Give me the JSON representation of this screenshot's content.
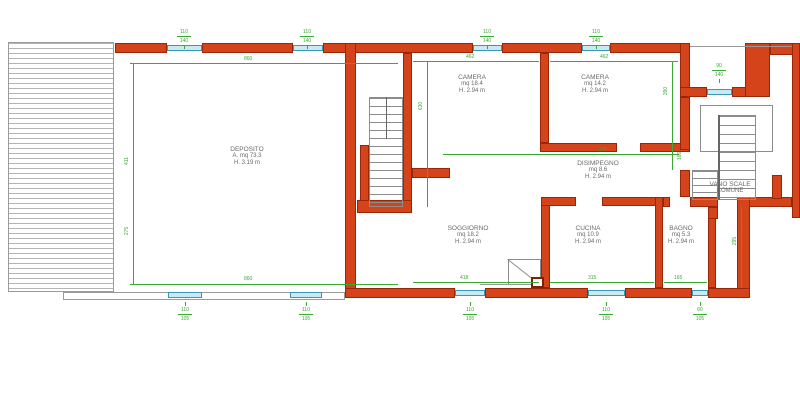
{
  "rooms": [
    {
      "name": "DEPOSITO",
      "l2": "A.   mq 73.3",
      "l3": "H.   3.19 m"
    },
    {
      "name": "CAMERA",
      "l2": "mq 18.4",
      "l3": "H.   2.94 m"
    },
    {
      "name": "CAMERA",
      "l2": "mq 14.2",
      "l3": "H.   2.94 m"
    },
    {
      "name": "DISIMPEGNO",
      "l2": "mq 8.6",
      "l3": "H.   2.94 m"
    },
    {
      "name": "SOGGIORNO",
      "l2": "mq 18.2",
      "l3": "H.   2.94 m"
    },
    {
      "name": "CUCINA",
      "l2": "mq 10.9",
      "l3": "H.   2.94 m"
    },
    {
      "name": "BAGNO",
      "l2": "mq 5.3",
      "l3": "H.   2.94 m"
    },
    {
      "name": "VANO SCALE",
      "l2": "COMUNE",
      "l3": ""
    }
  ],
  "dims": {
    "dep_top": "860",
    "dep_bottom": "860",
    "dep_left_upper": "411",
    "dep_left_lower": "275",
    "cam1_w": "462",
    "cam2_w": "462",
    "cam1_h": "630",
    "cam2_h": "390",
    "hall_w": "274",
    "hall_right": "166",
    "sogg_w": "418",
    "cuc_w": "315",
    "bagno_w": "165",
    "bagno_right": "295"
  },
  "window_dims": [
    {
      "id": "top-1",
      "w": "110",
      "h": "140"
    },
    {
      "id": "top-2",
      "w": "110",
      "h": "140"
    },
    {
      "id": "top-3",
      "w": "110",
      "h": "140"
    },
    {
      "id": "top-4",
      "w": "110",
      "h": "140"
    },
    {
      "id": "stairwell",
      "w": "90",
      "h": "140"
    },
    {
      "id": "bottom-1",
      "w": "110",
      "h": "105"
    },
    {
      "id": "bottom-2",
      "w": "110",
      "h": "105"
    },
    {
      "id": "bottom-3",
      "w": "110",
      "h": "105"
    },
    {
      "id": "bottom-4",
      "w": "110",
      "h": "105"
    },
    {
      "id": "bottom-5",
      "w": "60",
      "h": "105"
    }
  ],
  "colors": {
    "wall": "#d5431b",
    "wall_outline": "#992706",
    "window": "#cbe9f3",
    "window_line": "#3a98b4",
    "dimension": "#3aaa35",
    "room_label": "#6a6a6a"
  }
}
